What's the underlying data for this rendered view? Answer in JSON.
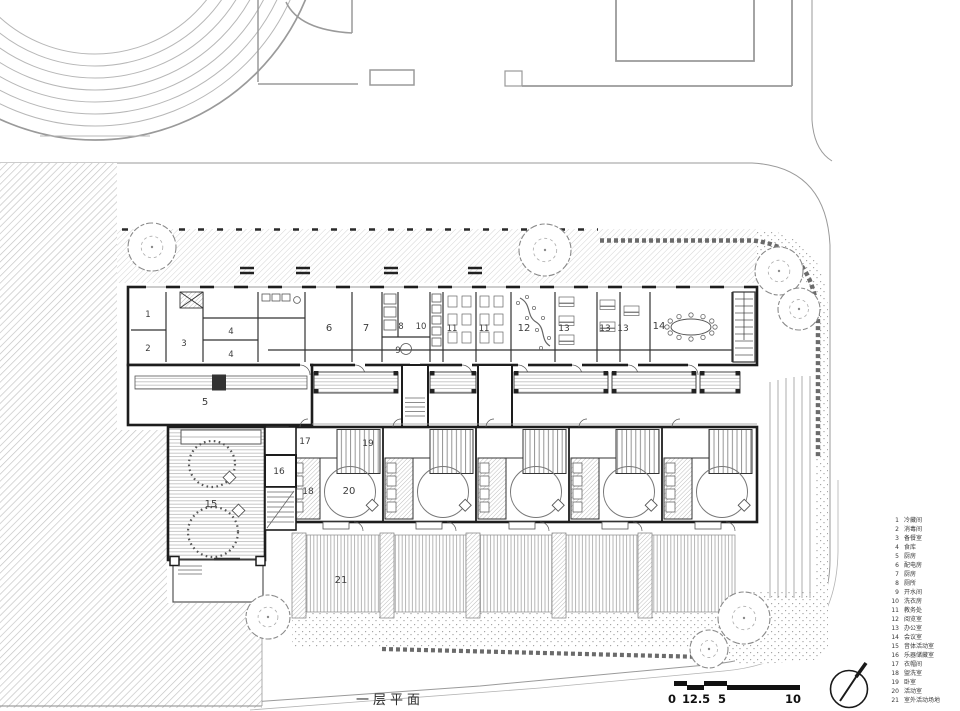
{
  "title": {
    "text": "一层平面"
  },
  "legend": {
    "items": [
      {
        "num": "1",
        "label": "冷藏间"
      },
      {
        "num": "2",
        "label": "消毒间"
      },
      {
        "num": "3",
        "label": "备餐室"
      },
      {
        "num": "4",
        "label": "食库"
      },
      {
        "num": "5",
        "label": "厨房"
      },
      {
        "num": "6",
        "label": "配电房"
      },
      {
        "num": "7",
        "label": "厨房"
      },
      {
        "num": "8",
        "label": "厕所"
      },
      {
        "num": "9",
        "label": "开水间"
      },
      {
        "num": "10",
        "label": "洗衣房"
      },
      {
        "num": "11",
        "label": "教务处"
      },
      {
        "num": "12",
        "label": "阅览室"
      },
      {
        "num": "13",
        "label": "办公室"
      },
      {
        "num": "14",
        "label": "会议室"
      },
      {
        "num": "15",
        "label": "音体活动室"
      },
      {
        "num": "16",
        "label": "乐器储藏室"
      },
      {
        "num": "17",
        "label": "衣帽间"
      },
      {
        "num": "18",
        "label": "盥洗室"
      },
      {
        "num": "19",
        "label": "卧室"
      },
      {
        "num": "20",
        "label": "活动室"
      },
      {
        "num": "21",
        "label": "室外活动场地"
      }
    ]
  },
  "scalebar": {
    "labels": [
      {
        "text": "0",
        "x": 672
      },
      {
        "text": "1",
        "x": 686
      },
      {
        "text": "2.5",
        "x": 700
      },
      {
        "text": "5",
        "x": 722
      },
      {
        "text": "10",
        "x": 793
      }
    ]
  },
  "plan_labels": [
    {
      "text": "1",
      "x": 148,
      "y": 317,
      "s": 8.5
    },
    {
      "text": "2",
      "x": 148,
      "y": 351,
      "s": 8.5
    },
    {
      "text": "3",
      "x": 184,
      "y": 346,
      "s": 8.5
    },
    {
      "text": "4",
      "x": 231,
      "y": 334,
      "s": 8.5
    },
    {
      "text": "4",
      "x": 231,
      "y": 357,
      "s": 8.5
    },
    {
      "text": "5",
      "x": 205,
      "y": 405,
      "s": 10
    },
    {
      "text": "6",
      "x": 329,
      "y": 331,
      "s": 10
    },
    {
      "text": "7",
      "x": 366,
      "y": 331,
      "s": 10
    },
    {
      "text": "8",
      "x": 401,
      "y": 329,
      "s": 8.5
    },
    {
      "text": "9",
      "x": 398,
      "y": 353,
      "s": 8.5
    },
    {
      "text": "10",
      "x": 421,
      "y": 329,
      "s": 8.5
    },
    {
      "text": "11",
      "x": 452,
      "y": 331,
      "s": 8.5
    },
    {
      "text": "11",
      "x": 484,
      "y": 331,
      "s": 8.5
    },
    {
      "text": "12",
      "x": 524,
      "y": 331,
      "s": 10
    },
    {
      "text": "13",
      "x": 564,
      "y": 331,
      "s": 9
    },
    {
      "text": "13",
      "x": 605,
      "y": 331,
      "s": 9
    },
    {
      "text": "13",
      "x": 623,
      "y": 331,
      "s": 9
    },
    {
      "text": "14",
      "x": 659,
      "y": 329,
      "s": 10
    },
    {
      "text": "15",
      "x": 211,
      "y": 507,
      "s": 10
    },
    {
      "text": "16",
      "x": 279,
      "y": 474,
      "s": 9
    },
    {
      "text": "17",
      "x": 305,
      "y": 444,
      "s": 9
    },
    {
      "text": "18",
      "x": 308,
      "y": 494,
      "s": 9
    },
    {
      "text": "19",
      "x": 368,
      "y": 446,
      "s": 9
    },
    {
      "text": "20",
      "x": 349,
      "y": 494,
      "s": 10
    },
    {
      "text": "21",
      "x": 341,
      "y": 583,
      "s": 10
    }
  ],
  "colors": {
    "wall": "#1d1d1d",
    "partition": "#333333",
    "context": "#9a9a9a",
    "accent": "#111111"
  }
}
